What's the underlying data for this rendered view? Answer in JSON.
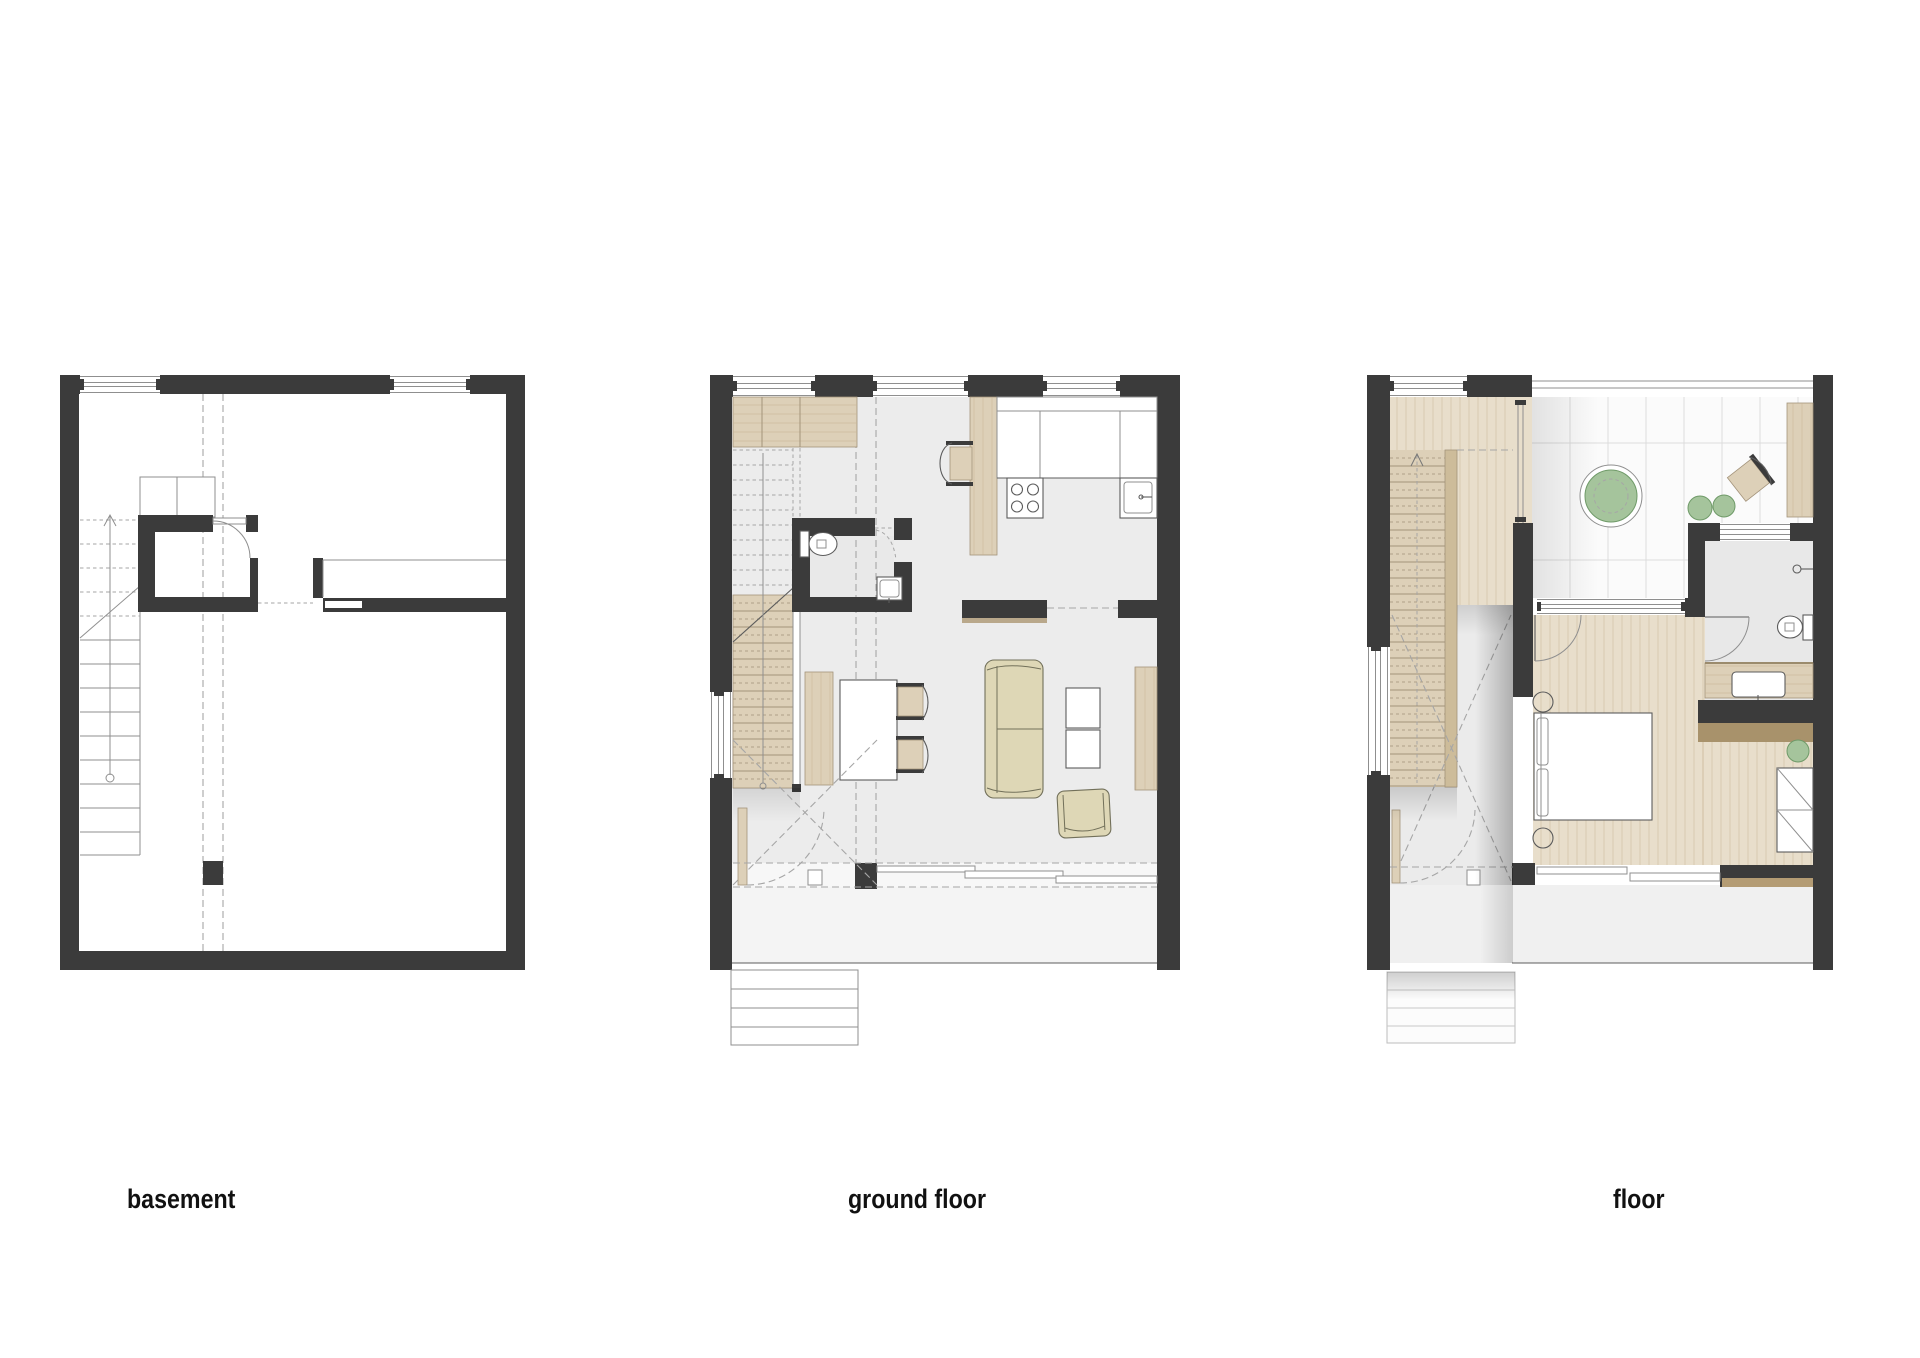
{
  "plans": [
    {
      "label": "basement"
    },
    {
      "label": "ground floor"
    },
    {
      "label": "floor"
    }
  ],
  "colors": {
    "wall": "#3b3b3b",
    "line": "#8f8f8f",
    "line_strong": "#5c5c5c",
    "dash": "#a6a6a6",
    "floor": "#ececec",
    "floor_light": "#f4f4f4",
    "terrace_tile": "#fbfbfb",
    "tile_line": "#dcdcdc",
    "wood": "#ddd0b8",
    "wood_floor": "#e8decb",
    "wood_dark": "#a8926b",
    "wood_rail": "#cdbc9a",
    "wood_line": "#a3937a",
    "grain": "#c6b493",
    "sofa": "#ded7b6",
    "sofa_line": "#72705a",
    "green": "#a5c49c",
    "green_dark": "#6f9a68",
    "label": "#111111",
    "page_bg": "#ffffff"
  }
}
